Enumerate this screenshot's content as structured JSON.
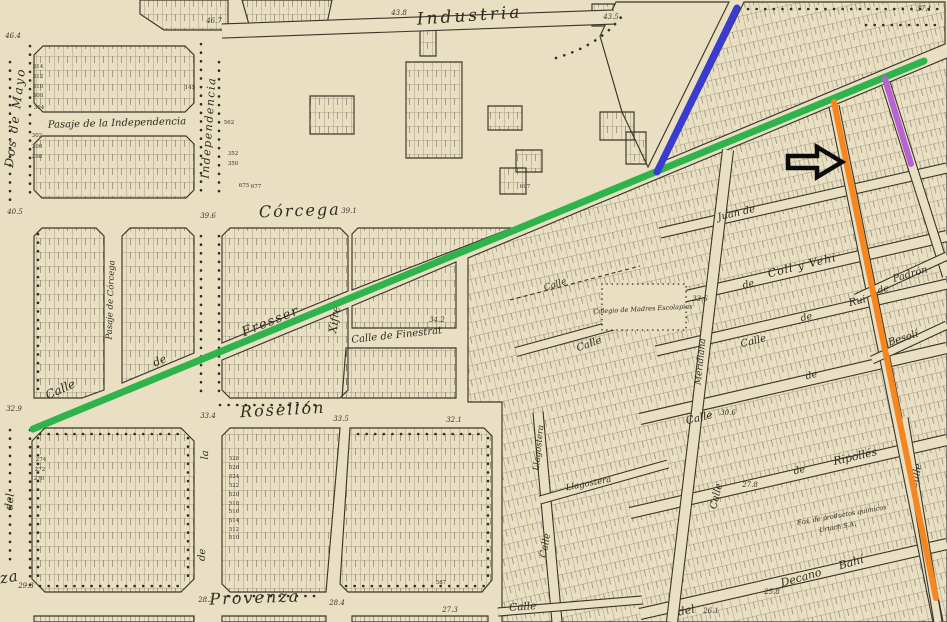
{
  "map": {
    "palette": {
      "paper": "#e9e0c3",
      "ink": "#3b3529",
      "parcel_line": "#57503e",
      "overlay_green": "#2fb34c",
      "overlay_blue": "#3a3ccf",
      "overlay_orange": "#f6861f",
      "overlay_purple": "#b763d6",
      "overlay_black": "#0b0b0b"
    },
    "street_labels": [
      {
        "text": "Industria",
        "x": 470,
        "y": 21,
        "rot": -4,
        "size": 17,
        "sp": 3
      },
      {
        "text": "Córcega",
        "x": 300,
        "y": 216,
        "rot": -2,
        "size": 16,
        "sp": 2
      },
      {
        "text": "Rosellón",
        "x": 283,
        "y": 415,
        "rot": -3,
        "size": 16,
        "sp": 2
      },
      {
        "text": "Provenza",
        "x": 255,
        "y": 603,
        "rot": -2,
        "size": 16,
        "sp": 2
      },
      {
        "text": "za",
        "x": 10,
        "y": 582,
        "rot": -10,
        "size": 15,
        "sp": 1
      },
      {
        "text": "Dos  de  Mayo",
        "x": 19,
        "y": 118,
        "rot": -83,
        "size": 12,
        "sp": 2
      },
      {
        "text": "Independencia",
        "x": 212,
        "y": 128,
        "rot": -86,
        "size": 11,
        "sp": 1.5
      },
      {
        "text": "Pasaje  de  la  Independencia",
        "x": 117,
        "y": 126,
        "rot": -1.5,
        "size": 10
      },
      {
        "text": "Pasaje de Córcega",
        "x": 113,
        "y": 300,
        "rot": -88,
        "size": 8.5
      },
      {
        "text": "Calle",
        "x": 62,
        "y": 393,
        "rot": -24,
        "size": 12
      },
      {
        "text": "de",
        "x": 161,
        "y": 364,
        "rot": -23,
        "size": 11
      },
      {
        "text": "Fresser",
        "x": 272,
        "y": 325,
        "rot": -22,
        "size": 13,
        "sp": 1.5
      },
      {
        "text": "Xifré",
        "x": 338,
        "y": 320,
        "rot": -82,
        "size": 11
      },
      {
        "text": "Calle  de  Finestrat",
        "x": 397,
        "y": 338,
        "rot": -6,
        "size": 10
      },
      {
        "text": "del",
        "x": 13,
        "y": 502,
        "rot": -85,
        "size": 11
      },
      {
        "text": "la",
        "x": 208,
        "y": 455,
        "rot": -87,
        "size": 10
      },
      {
        "text": "de",
        "x": 205,
        "y": 555,
        "rot": -87,
        "size": 10
      },
      {
        "text": "del",
        "x": 687,
        "y": 614,
        "rot": -12,
        "size": 11
      },
      {
        "text": "Juan  de",
        "x": 737,
        "y": 216,
        "rot": -13,
        "size": 10
      },
      {
        "text": "de",
        "x": 749,
        "y": 287,
        "rot": -14,
        "size": 9.5
      },
      {
        "text": "Coll  y  Vehi",
        "x": 803,
        "y": 269,
        "rot": -14,
        "size": 11,
        "sp": 1
      },
      {
        "text": "Calle",
        "x": 754,
        "y": 344,
        "rot": -14,
        "size": 10
      },
      {
        "text": "de",
        "x": 807,
        "y": 320,
        "rot": -14,
        "size": 9.5
      },
      {
        "text": "Rui",
        "x": 858,
        "y": 304,
        "rot": -14,
        "size": 10
      },
      {
        "text": "Calle",
        "x": 700,
        "y": 421,
        "rot": -14,
        "size": 10.5
      },
      {
        "text": "de",
        "x": 812,
        "y": 378,
        "rot": -14,
        "size": 9.5
      },
      {
        "text": "Calle",
        "x": 719,
        "y": 497,
        "rot": -76,
        "size": 10
      },
      {
        "text": "Meridiana",
        "x": 703,
        "y": 362,
        "rot": -84,
        "size": 9
      },
      {
        "text": "de",
        "x": 800,
        "y": 473,
        "rot": -14,
        "size": 9.5
      },
      {
        "text": "Ripollés",
        "x": 856,
        "y": 460,
        "rot": -13,
        "size": 11
      },
      {
        "text": "Decano",
        "x": 802,
        "y": 581,
        "rot": -16,
        "size": 11
      },
      {
        "text": "Bahí",
        "x": 852,
        "y": 566,
        "rot": -16,
        "size": 11
      },
      {
        "text": "de",
        "x": 884,
        "y": 292,
        "rot": -16,
        "size": 9
      },
      {
        "text": "Padrón",
        "x": 911,
        "y": 277,
        "rot": -16,
        "size": 10
      },
      {
        "text": "Besolí",
        "x": 904,
        "y": 341,
        "rot": -18,
        "size": 10
      },
      {
        "text": "Calle",
        "x": 919,
        "y": 477,
        "rot": -78,
        "size": 10
      },
      {
        "text": "Llagostera",
        "x": 541,
        "y": 448,
        "rot": -84,
        "size": 8.5
      },
      {
        "text": "Llagostera",
        "x": 589,
        "y": 486,
        "rot": -11,
        "size": 8.5
      },
      {
        "text": "Calle",
        "x": 548,
        "y": 546,
        "rot": -80,
        "size": 9.5
      },
      {
        "text": "Calle",
        "x": 523,
        "y": 610,
        "rot": -4,
        "size": 10.5
      },
      {
        "text": "Calle",
        "x": 556,
        "y": 287,
        "rot": -18,
        "size": 9
      },
      {
        "text": "Calle",
        "x": 590,
        "y": 347,
        "rot": -20,
        "size": 10
      },
      {
        "text": "Colegio de Madres Escolapias",
        "x": 643,
        "y": 311,
        "rot": -3,
        "size": 6.5
      },
      {
        "text": "Fca. de productos químicos",
        "x": 842,
        "y": 517,
        "rot": -10,
        "size": 6.5
      },
      {
        "text": "Uriach  S.A.",
        "x": 838,
        "y": 529,
        "rot": -10,
        "size": 6.5
      }
    ],
    "elevations": [
      {
        "text": "46.4",
        "x": 13,
        "y": 38
      },
      {
        "text": "46.7",
        "x": 214,
        "y": 23
      },
      {
        "text": "43.8",
        "x": 399,
        "y": 15
      },
      {
        "text": "43.5",
        "x": 611,
        "y": 19
      },
      {
        "text": "37.1",
        "x": 924,
        "y": 11
      },
      {
        "text": "40.5",
        "x": 15,
        "y": 214
      },
      {
        "text": "39.6",
        "x": 208,
        "y": 218
      },
      {
        "text": "39.1",
        "x": 349,
        "y": 213
      },
      {
        "text": "34.2",
        "x": 437,
        "y": 322
      },
      {
        "text": "33.6",
        "x": 700,
        "y": 301
      },
      {
        "text": "33.4",
        "x": 208,
        "y": 418
      },
      {
        "text": "33.5",
        "x": 341,
        "y": 421
      },
      {
        "text": "32.1",
        "x": 454,
        "y": 422
      },
      {
        "text": "32.9",
        "x": 14,
        "y": 411
      },
      {
        "text": "29.3",
        "x": 26,
        "y": 588
      },
      {
        "text": "28.3",
        "x": 206,
        "y": 602
      },
      {
        "text": "28.4",
        "x": 337,
        "y": 605
      },
      {
        "text": "27.3",
        "x": 450,
        "y": 612
      },
      {
        "text": "30.6",
        "x": 728,
        "y": 415
      },
      {
        "text": "27.8",
        "x": 750,
        "y": 487
      },
      {
        "text": "25.8",
        "x": 772,
        "y": 594
      },
      {
        "text": "26.1",
        "x": 711,
        "y": 613
      }
    ],
    "parcel_numbers": [
      {
        "text": "314",
        "x": 38,
        "y": 68
      },
      {
        "text": "312",
        "x": 38,
        "y": 78
      },
      {
        "text": "310",
        "x": 38,
        "y": 88
      },
      {
        "text": "308",
        "x": 38,
        "y": 97
      },
      {
        "text": "304",
        "x": 39,
        "y": 109
      },
      {
        "text": "302",
        "x": 37,
        "y": 137
      },
      {
        "text": "300",
        "x": 37,
        "y": 148
      },
      {
        "text": "298",
        "x": 37,
        "y": 158
      },
      {
        "text": "145",
        "x": 190,
        "y": 89
      },
      {
        "text": "562",
        "x": 229,
        "y": 124
      },
      {
        "text": "352",
        "x": 233,
        "y": 155
      },
      {
        "text": "350",
        "x": 233,
        "y": 165
      },
      {
        "text": "675",
        "x": 244,
        "y": 187
      },
      {
        "text": "677",
        "x": 256,
        "y": 188
      },
      {
        "text": "697",
        "x": 525,
        "y": 188
      },
      {
        "text": "274",
        "x": 41,
        "y": 461
      },
      {
        "text": "272",
        "x": 40,
        "y": 471
      },
      {
        "text": "270",
        "x": 39,
        "y": 480
      },
      {
        "text": "528",
        "x": 234,
        "y": 460
      },
      {
        "text": "526",
        "x": 234,
        "y": 469
      },
      {
        "text": "524",
        "x": 234,
        "y": 478
      },
      {
        "text": "522",
        "x": 234,
        "y": 487
      },
      {
        "text": "520",
        "x": 234,
        "y": 496
      },
      {
        "text": "518",
        "x": 234,
        "y": 505
      },
      {
        "text": "516",
        "x": 234,
        "y": 513
      },
      {
        "text": "514",
        "x": 234,
        "y": 522
      },
      {
        "text": "512",
        "x": 234,
        "y": 531
      },
      {
        "text": "510",
        "x": 234,
        "y": 539
      },
      {
        "text": "587",
        "x": 441,
        "y": 584
      }
    ],
    "overlays": {
      "lines": [
        {
          "name": "green-line",
          "x1": 33,
          "y1": 429,
          "x2": 924,
          "y2": 61,
          "color": "#2fb34c",
          "width": 7
        },
        {
          "name": "blue-line",
          "x1": 737,
          "y1": 8,
          "x2": 657,
          "y2": 172,
          "color": "#3a3ccf",
          "width": 7
        },
        {
          "name": "orange-line",
          "x1": 834,
          "y1": 102,
          "x2": 936,
          "y2": 598,
          "color": "#f6861f",
          "width": 6
        },
        {
          "name": "purple-line",
          "x1": 885,
          "y1": 79,
          "x2": 911,
          "y2": 164,
          "color": "#b763d6",
          "width": 6
        }
      ],
      "arrow": {
        "points": "788,156 817,156 817,147 842,162 817,177 817,168 788,168",
        "color": "#0b0b0b",
        "width": 4.5
      }
    }
  }
}
